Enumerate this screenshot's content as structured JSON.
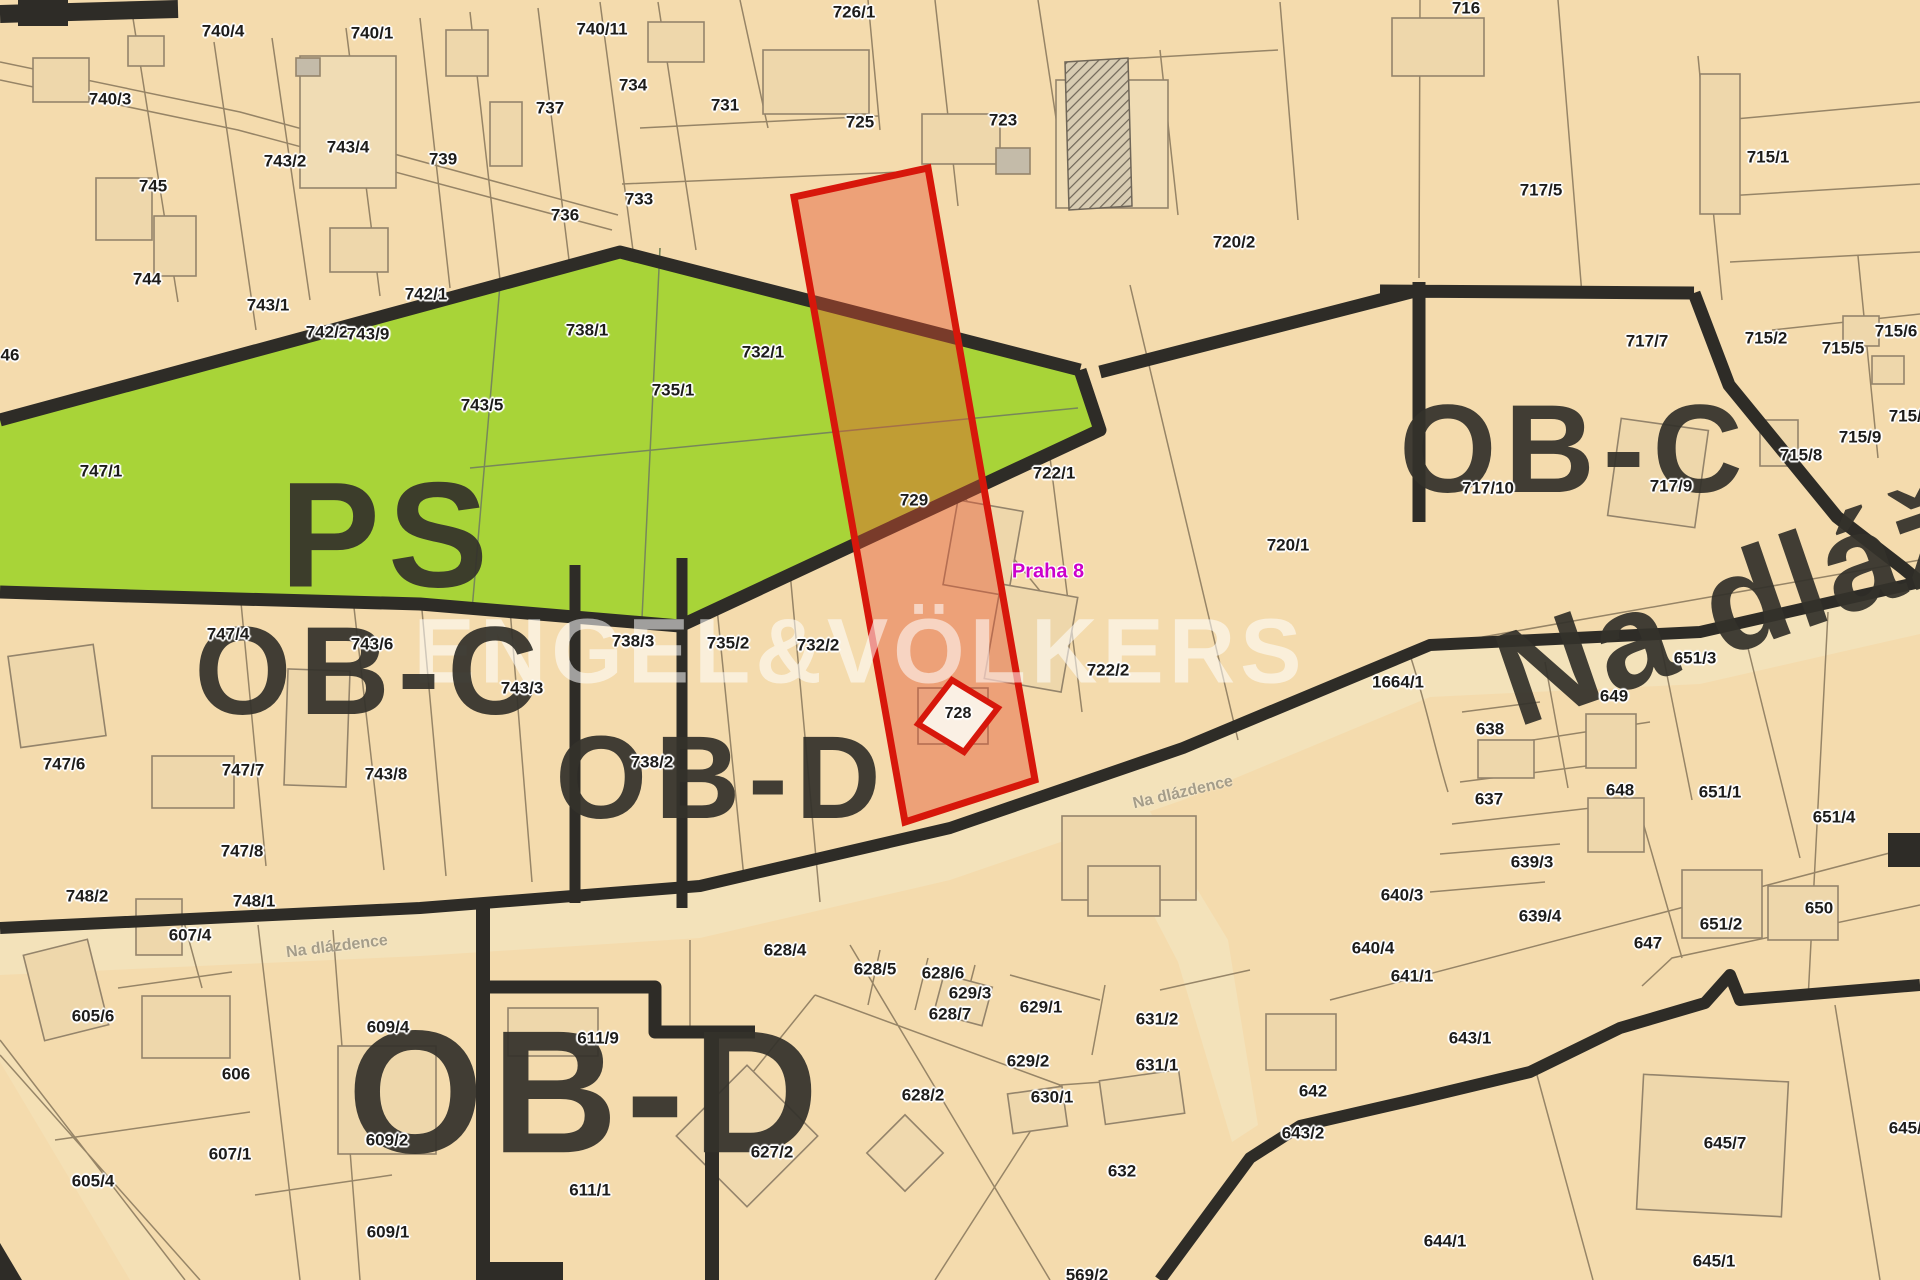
{
  "map": {
    "type": "cadastral-zoning-map",
    "background_color": "#f4dbad",
    "green_zone_color": "#a8d438",
    "highlight_outline_color": "#d7170b",
    "highlight_fill_color": "rgba(227,82,47,0.42)",
    "boundary_color": "#2e2c27",
    "parcel_line_color": "#86755a"
  },
  "watermark": {
    "text": "ENGEL&VÖLKERS",
    "x": 860,
    "y": 652
  },
  "city_label": {
    "text": "Praha 8",
    "color": "#cc00cc",
    "x": 1048,
    "y": 572
  },
  "zones": [
    {
      "label": "PS",
      "x": 388,
      "y": 535,
      "font": 150
    },
    {
      "label": "OB-C",
      "x": 370,
      "y": 672,
      "font": 125
    },
    {
      "label": "OB-C",
      "x": 1575,
      "y": 450,
      "font": 125
    },
    {
      "label": "OB-D",
      "x": 722,
      "y": 778,
      "font": 118
    },
    {
      "label": "OB-D",
      "x": 587,
      "y": 1093,
      "font": 175
    }
  ],
  "streets": {
    "giant": {
      "text": "Na dlážděnce",
      "x": 1527,
      "y": 722,
      "rotation": -19
    },
    "small": [
      {
        "text": "Na dlázdence",
        "x": 337,
        "y": 947,
        "rotation": -7
      },
      {
        "text": "Na dlázdence",
        "x": 1183,
        "y": 793,
        "rotation": -13
      }
    ]
  },
  "highlight": {
    "parcel_labels": [
      "729",
      "728"
    ]
  },
  "parcels": [
    {
      "label": "740/4",
      "x": 223,
      "y": 31
    },
    {
      "label": "740/1",
      "x": 372,
      "y": 33
    },
    {
      "label": "740/11",
      "x": 602,
      "y": 29
    },
    {
      "label": "726/1",
      "x": 854,
      "y": 12
    },
    {
      "label": "716",
      "x": 1466,
      "y": 8
    },
    {
      "label": "740/3",
      "x": 110,
      "y": 99
    },
    {
      "label": "734",
      "x": 633,
      "y": 85
    },
    {
      "label": "737",
      "x": 550,
      "y": 108
    },
    {
      "label": "731",
      "x": 725,
      "y": 105
    },
    {
      "label": "725",
      "x": 860,
      "y": 122
    },
    {
      "label": "723",
      "x": 1003,
      "y": 120
    },
    {
      "label": "743/4",
      "x": 348,
      "y": 147
    },
    {
      "label": "743/2",
      "x": 285,
      "y": 161
    },
    {
      "label": "739",
      "x": 443,
      "y": 159
    },
    {
      "label": "745",
      "x": 153,
      "y": 186
    },
    {
      "label": "715/1",
      "x": 1768,
      "y": 157
    },
    {
      "label": "717/5",
      "x": 1541,
      "y": 190
    },
    {
      "label": "733",
      "x": 639,
      "y": 199
    },
    {
      "label": "736",
      "x": 565,
      "y": 215
    },
    {
      "label": "720/2",
      "x": 1234,
      "y": 242
    },
    {
      "label": "744",
      "x": 147,
      "y": 279
    },
    {
      "label": "742/1",
      "x": 426,
      "y": 294
    },
    {
      "label": "715/6",
      "x": 1896,
      "y": 331
    },
    {
      "label": "715/5",
      "x": 1843,
      "y": 348
    },
    {
      "label": "743/1",
      "x": 268,
      "y": 305
    },
    {
      "label": "742/2",
      "x": 327,
      "y": 332
    },
    {
      "label": "743/9",
      "x": 368,
      "y": 334
    },
    {
      "label": "46",
      "x": 10,
      "y": 355
    },
    {
      "label": "732/1",
      "x": 763,
      "y": 352
    },
    {
      "label": "735/1",
      "x": 673,
      "y": 390
    },
    {
      "label": "738/1",
      "x": 587,
      "y": 330
    },
    {
      "label": "717/7",
      "x": 1647,
      "y": 341
    },
    {
      "label": "715/2",
      "x": 1766,
      "y": 338
    },
    {
      "label": "743/5",
      "x": 482,
      "y": 405
    },
    {
      "label": "715/9",
      "x": 1860,
      "y": 437
    },
    {
      "label": "715/8",
      "x": 1801,
      "y": 455
    },
    {
      "label": "715/3",
      "x": 1910,
      "y": 416
    },
    {
      "label": "747/1",
      "x": 101,
      "y": 471
    },
    {
      "label": "722/1",
      "x": 1054,
      "y": 473
    },
    {
      "label": "729",
      "x": 914,
      "y": 500
    },
    {
      "label": "717/10",
      "x": 1488,
      "y": 488
    },
    {
      "label": "717/9",
      "x": 1671,
      "y": 486
    },
    {
      "label": "720/1",
      "x": 1288,
      "y": 545
    },
    {
      "label": "722/2",
      "x": 1108,
      "y": 670
    },
    {
      "label": "732/2",
      "x": 818,
      "y": 645
    },
    {
      "label": "735/2",
      "x": 728,
      "y": 643
    },
    {
      "label": "738/3",
      "x": 633,
      "y": 641
    },
    {
      "label": "743/3",
      "x": 522,
      "y": 688
    },
    {
      "label": "738/2",
      "x": 652,
      "y": 762
    },
    {
      "label": "747/4",
      "x": 228,
      "y": 634
    },
    {
      "label": "743/6",
      "x": 372,
      "y": 644
    },
    {
      "label": "747/6",
      "x": 64,
      "y": 764
    },
    {
      "label": "747/7",
      "x": 243,
      "y": 770
    },
    {
      "label": "743/8",
      "x": 386,
      "y": 774
    },
    {
      "label": "747/8",
      "x": 242,
      "y": 851
    },
    {
      "label": "748/2",
      "x": 87,
      "y": 896
    },
    {
      "label": "748/1",
      "x": 254,
      "y": 901
    },
    {
      "label": "1664/1",
      "x": 1398,
      "y": 682
    },
    {
      "label": "651/3",
      "x": 1695,
      "y": 658
    },
    {
      "label": "649",
      "x": 1614,
      "y": 696
    },
    {
      "label": "638",
      "x": 1490,
      "y": 729
    },
    {
      "label": "637",
      "x": 1489,
      "y": 799
    },
    {
      "label": "648",
      "x": 1620,
      "y": 790
    },
    {
      "label": "651/1",
      "x": 1720,
      "y": 792
    },
    {
      "label": "651/4",
      "x": 1834,
      "y": 817
    },
    {
      "label": "639/3",
      "x": 1532,
      "y": 862
    },
    {
      "label": "639/4",
      "x": 1540,
      "y": 916
    },
    {
      "label": "640/3",
      "x": 1402,
      "y": 895
    },
    {
      "label": "651/2",
      "x": 1721,
      "y": 924
    },
    {
      "label": "650",
      "x": 1819,
      "y": 908
    },
    {
      "label": "647",
      "x": 1648,
      "y": 943
    },
    {
      "label": "728",
      "x": 958,
      "y": 714,
      "s": 16
    },
    {
      "label": "607/4",
      "x": 190,
      "y": 935
    },
    {
      "label": "605/6",
      "x": 93,
      "y": 1016
    },
    {
      "label": "606",
      "x": 236,
      "y": 1074
    },
    {
      "label": "609/4",
      "x": 388,
      "y": 1027
    },
    {
      "label": "611/9",
      "x": 598,
      "y": 1038
    },
    {
      "label": "605/4",
      "x": 93,
      "y": 1181
    },
    {
      "label": "607/1",
      "x": 230,
      "y": 1154
    },
    {
      "label": "609/2",
      "x": 387,
      "y": 1140
    },
    {
      "label": "611/1",
      "x": 590,
      "y": 1190
    },
    {
      "label": "609/1",
      "x": 388,
      "y": 1232
    },
    {
      "label": "628/4",
      "x": 785,
      "y": 950
    },
    {
      "label": "628/5",
      "x": 875,
      "y": 969
    },
    {
      "label": "628/6",
      "x": 943,
      "y": 973
    },
    {
      "label": "629/3",
      "x": 970,
      "y": 993
    },
    {
      "label": "628/7",
      "x": 950,
      "y": 1014
    },
    {
      "label": "629/1",
      "x": 1041,
      "y": 1007
    },
    {
      "label": "631/2",
      "x": 1157,
      "y": 1019
    },
    {
      "label": "629/2",
      "x": 1028,
      "y": 1061
    },
    {
      "label": "631/1",
      "x": 1157,
      "y": 1065
    },
    {
      "label": "628/2",
      "x": 923,
      "y": 1095
    },
    {
      "label": "630/1",
      "x": 1052,
      "y": 1097
    },
    {
      "label": "627/2",
      "x": 772,
      "y": 1152
    },
    {
      "label": "632",
      "x": 1122,
      "y": 1171
    },
    {
      "label": "569/2",
      "x": 1087,
      "y": 1275
    },
    {
      "label": "643/2",
      "x": 1303,
      "y": 1133
    },
    {
      "label": "642",
      "x": 1313,
      "y": 1091
    },
    {
      "label": "640/4",
      "x": 1373,
      "y": 948
    },
    {
      "label": "641/1",
      "x": 1412,
      "y": 976
    },
    {
      "label": "643/1",
      "x": 1470,
      "y": 1038
    },
    {
      "label": "644/1",
      "x": 1445,
      "y": 1241
    },
    {
      "label": "645/7",
      "x": 1725,
      "y": 1143
    },
    {
      "label": "645/1",
      "x": 1714,
      "y": 1261
    },
    {
      "label": "645/1",
      "x": 1910,
      "y": 1128
    }
  ]
}
